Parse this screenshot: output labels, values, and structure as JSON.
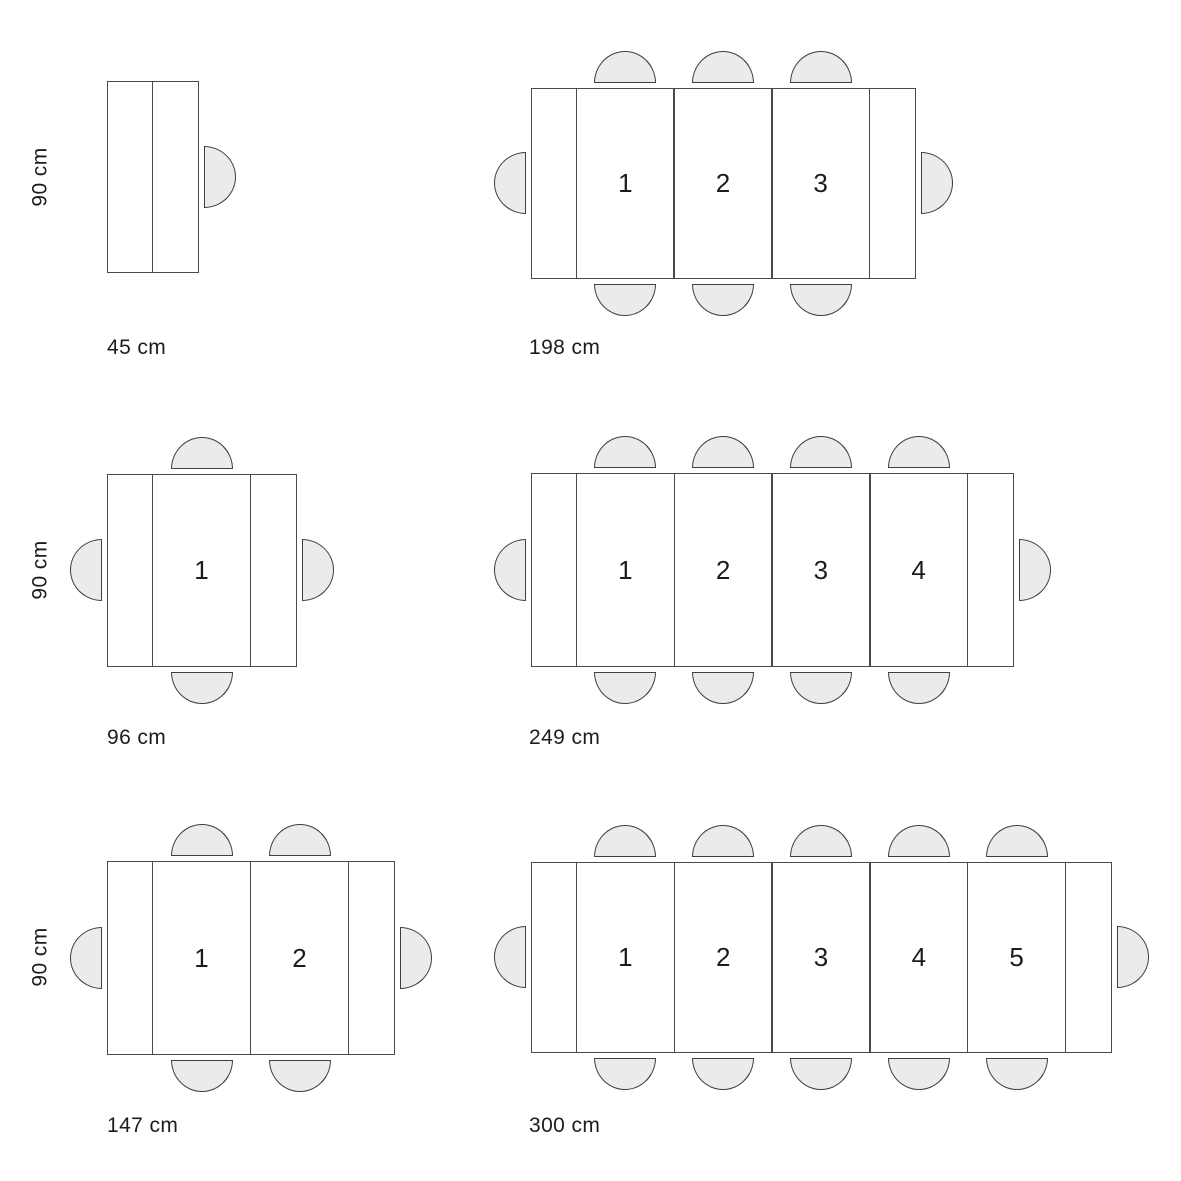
{
  "figure": {
    "type": "extendable-dining-table-size-diagram",
    "unit": "cm",
    "depth_cm": 90,
    "colors": {
      "background": "#ffffff",
      "table_fill": "#ffffff",
      "table_stroke": "#4a4a4a",
      "chair_fill": "#ebebeb",
      "chair_stroke": "#3f3f3f",
      "text": "#1c1c1c"
    },
    "chair": {
      "seat_width": 62,
      "seat_depth": 32,
      "gap_to_table": 5
    },
    "depth_labels": [
      {
        "name": "depth-label-row1",
        "text": "90 cm",
        "cx": 40,
        "cy": 177
      },
      {
        "name": "depth-label-row2",
        "text": "90 cm",
        "cx": 40,
        "cy": 570
      },
      {
        "name": "depth-label-row3",
        "text": "90 cm",
        "cx": 40,
        "cy": 957
      }
    ],
    "tables": [
      {
        "name": "45cm",
        "length_label": "45 cm",
        "length_cm": 45,
        "leaf_numbers": [],
        "divider_fractions": [
          0.5
        ],
        "seats": 1,
        "chairs": {
          "top_per_leaf": false,
          "bottom_per_leaf": false,
          "left": false,
          "right": true
        },
        "geometry": {
          "x": 107,
          "y": 81,
          "w": 92,
          "h": 192,
          "end_w": 46
        },
        "label_pos": {
          "x": 107,
          "y": 337
        }
      },
      {
        "name": "198cm",
        "length_label": "198 cm",
        "length_cm": 198,
        "leaf_numbers": [
          "1",
          "2",
          "3"
        ],
        "divider_fractions": [],
        "seats": 8,
        "chairs": {
          "top_per_leaf": true,
          "bottom_per_leaf": true,
          "left": true,
          "right": true
        },
        "geometry": {
          "x": 531,
          "y": 88,
          "w": 385,
          "h": 191,
          "end_w": 46
        },
        "label_pos": {
          "x": 529,
          "y": 337
        }
      },
      {
        "name": "96cm",
        "length_label": "96 cm",
        "length_cm": 96,
        "leaf_numbers": [
          "1"
        ],
        "divider_fractions": [],
        "seats": 4,
        "chairs": {
          "top_per_leaf": true,
          "bottom_per_leaf": true,
          "left": true,
          "right": true
        },
        "geometry": {
          "x": 107,
          "y": 474,
          "w": 190,
          "h": 193,
          "end_w": 46
        },
        "label_pos": {
          "x": 107,
          "y": 727
        }
      },
      {
        "name": "249cm",
        "length_label": "249 cm",
        "length_cm": 249,
        "leaf_numbers": [
          "1",
          "2",
          "3",
          "4"
        ],
        "divider_fractions": [],
        "seats": 10,
        "chairs": {
          "top_per_leaf": true,
          "bottom_per_leaf": true,
          "left": true,
          "right": true
        },
        "geometry": {
          "x": 531,
          "y": 473,
          "w": 483,
          "h": 194,
          "end_w": 46
        },
        "label_pos": {
          "x": 529,
          "y": 727
        }
      },
      {
        "name": "147cm",
        "length_label": "147 cm",
        "length_cm": 147,
        "leaf_numbers": [
          "1",
          "2"
        ],
        "divider_fractions": [],
        "seats": 6,
        "chairs": {
          "top_per_leaf": true,
          "bottom_per_leaf": true,
          "left": true,
          "right": true
        },
        "geometry": {
          "x": 107,
          "y": 861,
          "w": 288,
          "h": 194,
          "end_w": 46
        },
        "label_pos": {
          "x": 107,
          "y": 1115
        }
      },
      {
        "name": "300cm",
        "length_label": "300 cm",
        "length_cm": 300,
        "leaf_numbers": [
          "1",
          "2",
          "3",
          "4",
          "5"
        ],
        "divider_fractions": [],
        "seats": 12,
        "chairs": {
          "top_per_leaf": true,
          "bottom_per_leaf": true,
          "left": true,
          "right": true
        },
        "geometry": {
          "x": 531,
          "y": 862,
          "w": 581,
          "h": 191,
          "end_w": 46
        },
        "label_pos": {
          "x": 529,
          "y": 1115
        }
      }
    ]
  }
}
